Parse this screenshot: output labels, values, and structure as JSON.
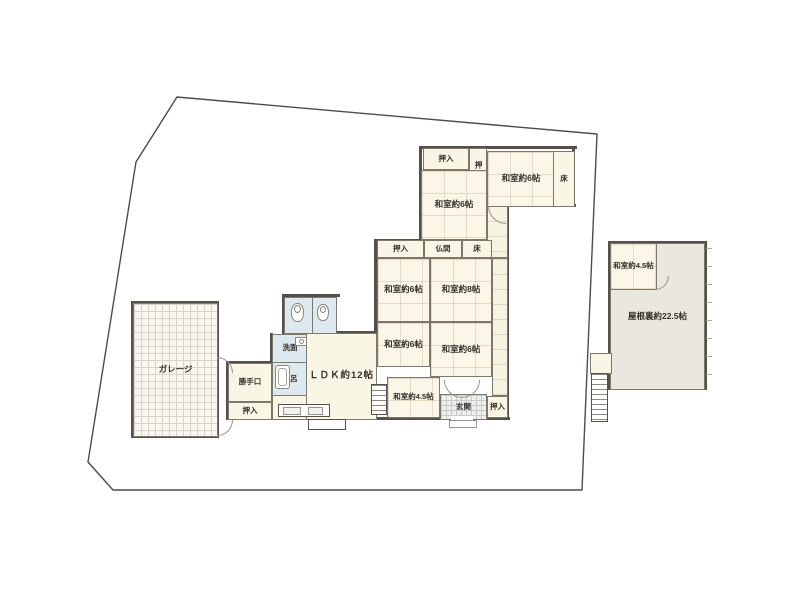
{
  "plan_title": "間取り図",
  "colors": {
    "wall": "#55514a",
    "boundary": "#4c4c4c",
    "tatami_fill": "#fbf7e8",
    "water_fill": "#dde9ef",
    "attic_fill": "#eae7de",
    "genkan_fill": "#eef0ee"
  },
  "boundary_points": "177,97 597,134 582,490 113,490 88,462 136,162",
  "rooms": [
    {
      "name": "garage",
      "label": "ガレージ",
      "x": 133,
      "y": 303,
      "w": 85,
      "h": 134,
      "cls": "grid-fine"
    },
    {
      "name": "katteguchi",
      "label": "勝手口",
      "x": 228,
      "y": 363,
      "w": 44,
      "h": 39,
      "cls": "plain",
      "small": true
    },
    {
      "name": "oshiire-kitchen",
      "label": "押入",
      "x": 228,
      "y": 402,
      "w": 44,
      "h": 18,
      "cls": "plain",
      "small": true
    },
    {
      "name": "kitchen-floor",
      "label": "",
      "x": 272,
      "y": 394,
      "w": 36,
      "h": 26,
      "cls": "plain"
    },
    {
      "name": "toilet-room-1",
      "label": "",
      "x": 284,
      "y": 297,
      "w": 29,
      "h": 37,
      "cls": "water"
    },
    {
      "name": "toilet-room-2",
      "label": "",
      "x": 312,
      "y": 297,
      "w": 25,
      "h": 37,
      "cls": "water"
    },
    {
      "name": "senmen",
      "label": "洗面",
      "x": 272,
      "y": 334,
      "w": 36,
      "h": 29,
      "cls": "water",
      "small": true
    },
    {
      "name": "furo",
      "label": "風呂",
      "x": 272,
      "y": 362,
      "w": 36,
      "h": 34,
      "cls": "water",
      "small": true
    },
    {
      "name": "ldk",
      "label": "ＬＤＫ約12帖",
      "x": 306,
      "y": 333,
      "w": 71,
      "h": 87,
      "cls": "plain",
      "big": true
    },
    {
      "name": "corridor-top",
      "label": "",
      "x": 487,
      "y": 205,
      "w": 21,
      "h": 53,
      "cls": "corridor"
    },
    {
      "name": "corridor-right",
      "label": "",
      "x": 492,
      "y": 258,
      "w": 16,
      "h": 138,
      "cls": "corridor"
    },
    {
      "name": "oshiire-top",
      "label": "押入",
      "x": 423,
      "y": 148,
      "w": 46,
      "h": 22,
      "cls": "plain",
      "small": true
    },
    {
      "name": "oshiire-top-vert",
      "label": "押入",
      "x": 469,
      "y": 148,
      "w": 18,
      "h": 42,
      "cls": "plain",
      "small": true,
      "vertical": true
    },
    {
      "name": "washitsu-6-top-right",
      "label": "和室約6帖",
      "x": 487,
      "y": 151,
      "w": 68,
      "h": 56,
      "cls": "tatami"
    },
    {
      "name": "toko-top",
      "label": "床",
      "x": 553,
      "y": 151,
      "w": 22,
      "h": 56,
      "cls": "plain",
      "small": true
    },
    {
      "name": "washitsu-6-top-left",
      "label": "和室約6帖",
      "x": 421,
      "y": 170,
      "w": 66,
      "h": 70,
      "cls": "tatami"
    },
    {
      "name": "oshiire-mid",
      "label": "押入",
      "x": 377,
      "y": 240,
      "w": 47,
      "h": 18,
      "cls": "plain",
      "small": true
    },
    {
      "name": "butsuma",
      "label": "仏間",
      "x": 424,
      "y": 240,
      "w": 38,
      "h": 18,
      "cls": "plain",
      "small": true
    },
    {
      "name": "toko-mid",
      "label": "床",
      "x": 462,
      "y": 240,
      "w": 30,
      "h": 18,
      "cls": "plain",
      "small": true
    },
    {
      "name": "washitsu-6-mid-west",
      "label": "和室約6帖",
      "x": 377,
      "y": 258,
      "w": 53,
      "h": 64,
      "cls": "tatami"
    },
    {
      "name": "washitsu-8",
      "label": "和室約8帖",
      "x": 430,
      "y": 258,
      "w": 62,
      "h": 64,
      "cls": "tatami"
    },
    {
      "name": "washitsu-6-south-west",
      "label": "和室約6帖",
      "x": 377,
      "y": 322,
      "w": 53,
      "h": 45,
      "cls": "tatami"
    },
    {
      "name": "washitsu-6-south-east",
      "label": "和室約6帖",
      "x": 430,
      "y": 322,
      "w": 62,
      "h": 55,
      "cls": "tatami"
    },
    {
      "name": "washitsu-45-main",
      "label": "和室約4.5帖",
      "x": 387,
      "y": 377,
      "w": 53,
      "h": 41,
      "cls": "tatami",
      "small": true
    },
    {
      "name": "genkan",
      "label": "玄関",
      "x": 440,
      "y": 394,
      "w": 47,
      "h": 26,
      "cls": "genkan",
      "small": true
    },
    {
      "name": "oshiire-genkan",
      "label": "押入",
      "x": 487,
      "y": 396,
      "w": 21,
      "h": 22,
      "cls": "plain",
      "small": true
    },
    {
      "name": "yaneura-attic",
      "label": "屋根裏約22.5帖",
      "x": 610,
      "y": 243,
      "w": 95,
      "h": 147,
      "cls": "attic"
    },
    {
      "name": "washitsu-45-annex",
      "label": "和室約4.5帖",
      "x": 610,
      "y": 243,
      "w": 47,
      "h": 47,
      "cls": "tatami",
      "small": true
    },
    {
      "name": "annex-stair-landing",
      "label": "",
      "x": 590,
      "y": 353,
      "w": 22,
      "h": 21,
      "cls": "plain"
    }
  ],
  "stairs": [
    {
      "name": "stairs-main",
      "x": 371,
      "y": 384,
      "w": 16,
      "h": 31
    },
    {
      "name": "stairs-annex",
      "x": 591,
      "y": 373,
      "w": 17,
      "h": 49
    }
  ],
  "walls": [
    [
      421,
      146,
      156,
      3
    ],
    [
      572,
      146,
      3,
      61
    ],
    [
      506,
      204,
      70,
      3
    ],
    [
      419,
      146,
      3,
      96
    ],
    [
      375,
      239,
      120,
      3
    ],
    [
      374,
      239,
      3,
      181
    ],
    [
      506,
      204,
      3,
      216
    ],
    [
      374,
      417,
      136,
      3
    ],
    [
      282,
      294,
      58,
      3
    ],
    [
      282,
      294,
      3,
      41
    ],
    [
      270,
      333,
      3,
      64
    ],
    [
      226,
      417,
      157,
      3
    ],
    [
      226,
      361,
      3,
      59
    ],
    [
      226,
      361,
      47,
      3
    ],
    [
      304,
      331,
      75,
      3
    ],
    [
      131,
      301,
      88,
      3
    ],
    [
      131,
      435,
      88,
      3
    ],
    [
      131,
      301,
      3,
      137
    ],
    [
      216,
      301,
      3,
      137
    ],
    [
      608,
      241,
      99,
      3
    ],
    [
      704,
      241,
      3,
      149
    ],
    [
      608,
      387,
      99,
      3
    ],
    [
      608,
      241,
      3,
      149
    ]
  ]
}
